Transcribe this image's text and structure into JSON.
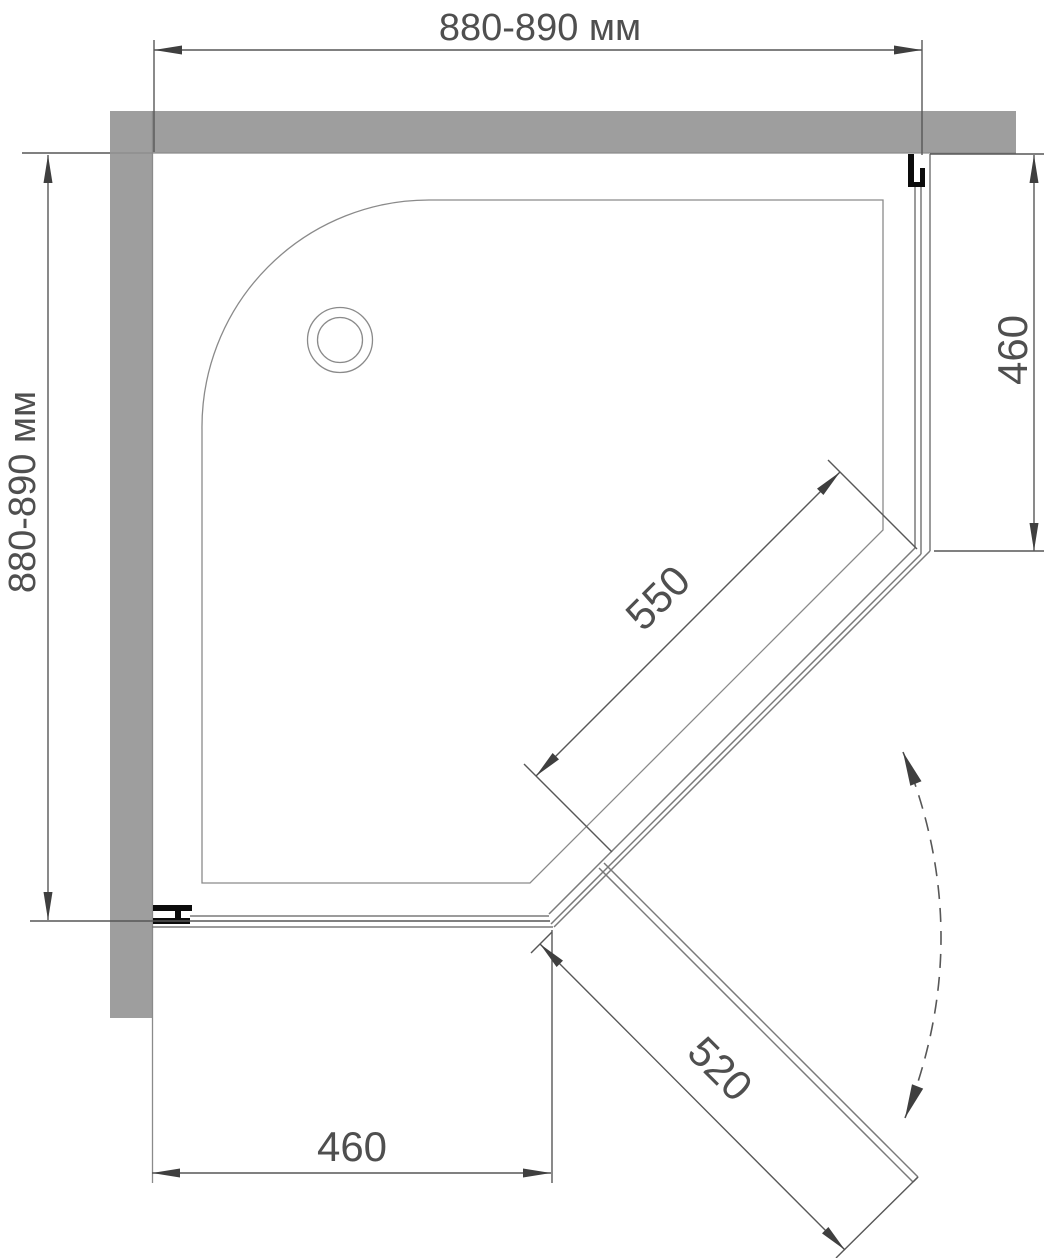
{
  "drawing": {
    "title": "Corner pentagonal shower enclosure — plan view installation drawing",
    "dimensions": {
      "top_width": "880-890 мм",
      "left_height": "880-890 мм",
      "right_side": "460",
      "bottom_side": "460",
      "fixed_diagonal_panel": "550",
      "door": "520"
    },
    "components": {
      "wall": "masonry wall (shaded)",
      "tray": "shower tray with rounded corner",
      "drain": "drain hole",
      "right_glass_panel": "fixed side glass panel",
      "front_glass_panel": "fixed front glass panel",
      "diagonal_fixed_panel": "diagonal fixed glass panel",
      "door_panel": "pivot door shown open",
      "swing_arc": "door swing direction arc",
      "wall_profiles": "wall mounting profiles"
    },
    "colors": {
      "background": "#ffffff",
      "wall": "#9e9e9e",
      "tray_line": "#8a8a8a",
      "glass_line": "#7a7a7a",
      "dim_line": "#575757",
      "arrow": "#3f3f3f",
      "text": "#4f4f4f",
      "profile": "#0c0c0c"
    }
  }
}
